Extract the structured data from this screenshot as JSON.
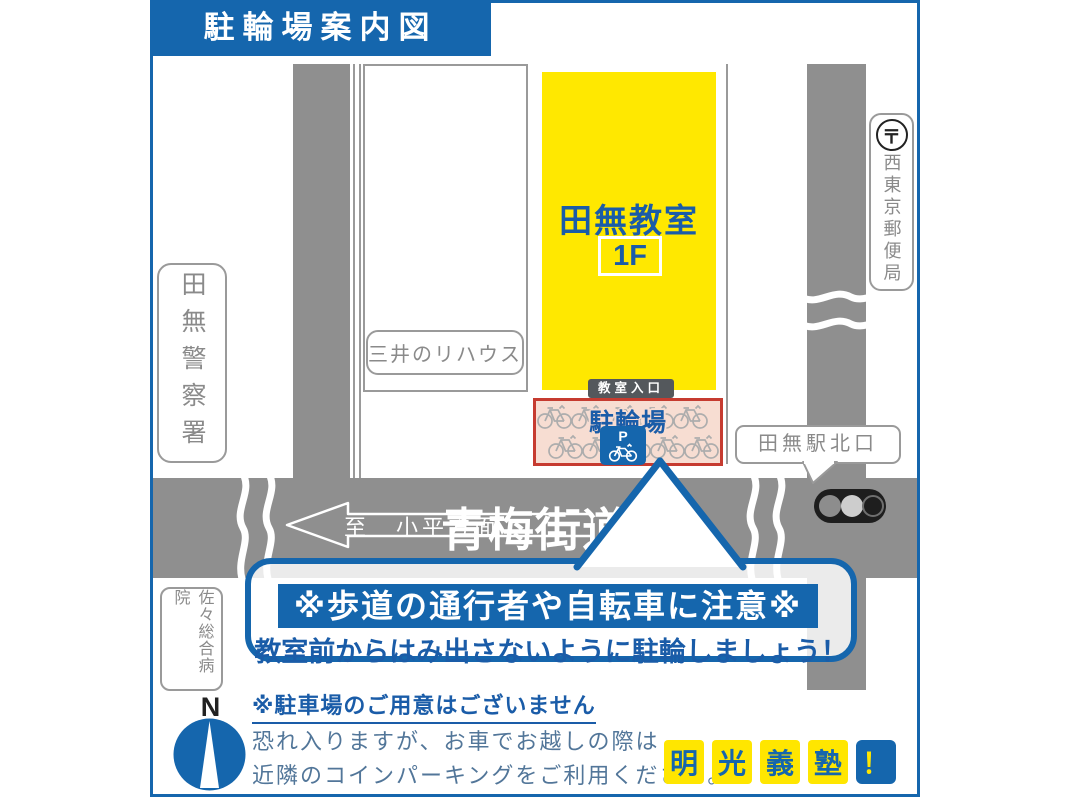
{
  "title": "駐輪場案内図",
  "map": {
    "building_name": "田無教室",
    "building_floor": "1F",
    "entrance_label": "教室入口",
    "parking_label": "駐輪場",
    "parking_sign": "P",
    "station_label": "田無駅北口",
    "police_label": "田無警察署",
    "post_office_symbol": "〒",
    "post_office_label": "西東京郵便局",
    "realtor_label": "三井のリハウス",
    "hospital_label": "佐々総合病院",
    "road_label": "青梅街道",
    "direction_label": "至　小平方面",
    "compass_label": "N"
  },
  "notice": {
    "line1": "※歩道の通行者や自転車に注意※",
    "line2": "教室前からはみ出さないように駐輪しましょう！"
  },
  "footer": {
    "no_parking": "※駐車場のご用意はございません",
    "note1": "恐れ入りますが、お車でお越しの際は",
    "note2": "近隣のコインパーキングをご利用ください。"
  },
  "logo": {
    "chars": [
      "明",
      "光",
      "義",
      "塾"
    ],
    "exclamation": "！"
  },
  "colors": {
    "primary_blue": "#1566ad",
    "text_blue": "#1a5ca8",
    "road_gray": "#8f8f8f",
    "label_gray": "#8a8a8a",
    "building_yellow": "#ffe800",
    "parking_bg": "#f7ddd2",
    "parking_border": "#c63b30",
    "muted_blue_text": "#527699",
    "logo_yellow": "#ffe600"
  }
}
